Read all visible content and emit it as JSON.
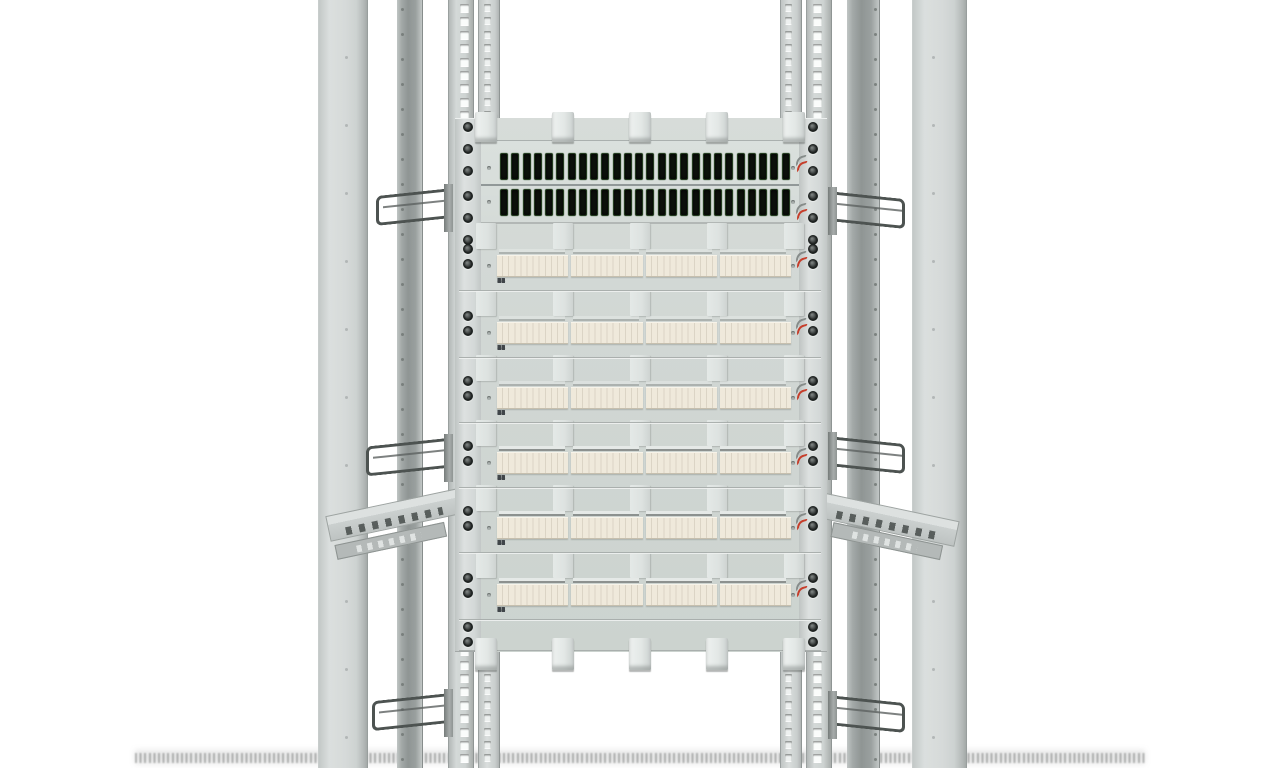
{
  "scene": {
    "subject": "Open-frame 19-inch telecom distribution rack, front view 3D render",
    "background": "#ffffff"
  },
  "fiber_panel": {
    "rows": 2,
    "adapters_per_row": 26,
    "adapter_color": "#0e130d",
    "adapter_accent": "#396033"
  },
  "distribution_modules": {
    "rows": 6,
    "groups_per_row": 4,
    "ports_per_group": 6,
    "port_numbers": [
      "1",
      "2",
      "3",
      "4",
      "5",
      "6",
      "7",
      "8",
      "9",
      "10",
      "11",
      "12",
      "13",
      "14",
      "15",
      "16",
      "17",
      "18",
      "19",
      "20",
      "21",
      "22",
      "23",
      "24"
    ],
    "block_color": "#efe9db",
    "number_color": "#41464a"
  },
  "hardware": {
    "cable_rings_left": 3,
    "cable_rings_right": 3,
    "guide_tabs_per_row": 5,
    "screw_color": "#3d4241",
    "latch_mark_color": "#c63d2a"
  },
  "palette": {
    "outer_post": "#d6dad9",
    "inner_post": "#8f9594",
    "rail": "#ced3d2",
    "rail_hole": "#fafcfb",
    "panel_face": "#d1d7d4",
    "flange": "#d3d8d7",
    "tab": "#e3e8e6",
    "wire_ring": "#4d5351"
  }
}
